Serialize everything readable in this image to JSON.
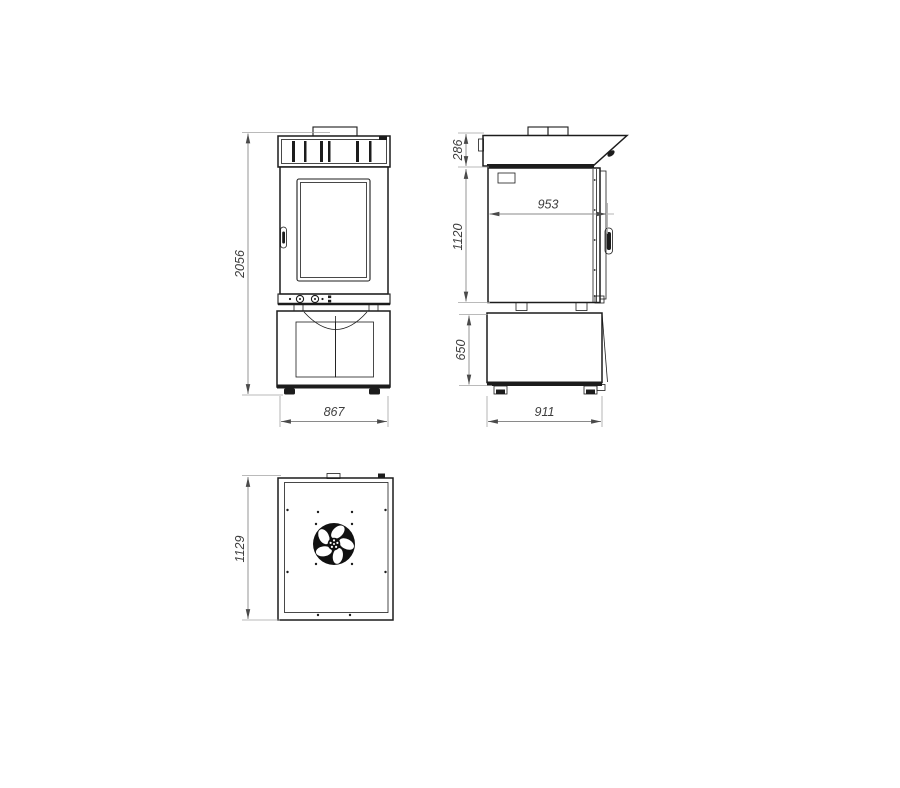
{
  "drawing": {
    "title": "oven-with-stand-orthographic-views",
    "views": [
      {
        "id": "front",
        "label": "front-view"
      },
      {
        "id": "side",
        "label": "side-view"
      },
      {
        "id": "top",
        "label": "top-view"
      }
    ],
    "dimensions": {
      "overall_height": "2056",
      "front_width": "867",
      "hood_height": "286",
      "body_height": "1120",
      "stand_height": "650",
      "inner_depth": "953",
      "side_depth": "911",
      "top_depth": "1129"
    },
    "icons": {
      "fan": "fan-icon"
    },
    "colors": {
      "object_line": "#1c1c1c",
      "dimension_line": "#8a8a8a",
      "dimension_text": "#3d3d3d",
      "background": "#ffffff"
    }
  }
}
